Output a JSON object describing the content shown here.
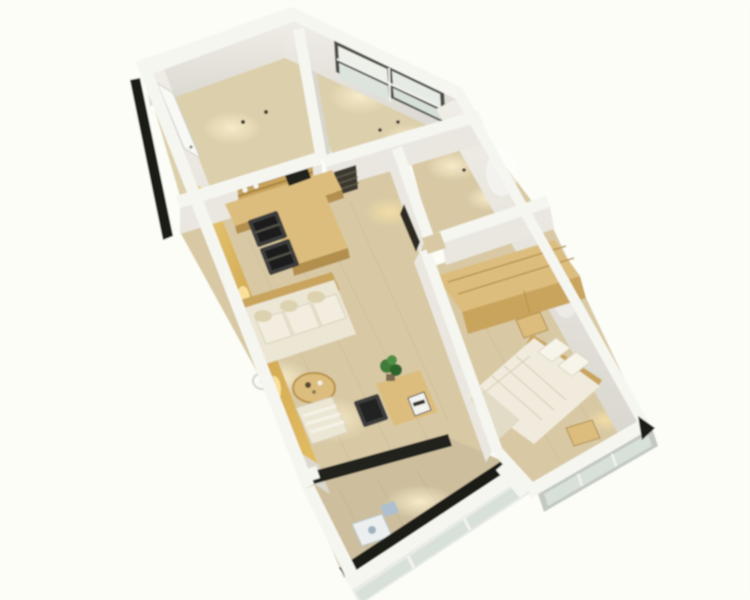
{
  "image": {
    "kind": "3d-apartment-floorplan-render",
    "background": "#fbfcf4"
  },
  "palette": {
    "bg": "#fbfcf4",
    "wall_top": "#f6f6f1",
    "wall_face": "#e9e7e0",
    "wall_face_dark": "#d7d5cd",
    "black_trim": "#1b1a17",
    "floor_a": "#dccfab",
    "floor_b": "#d8c9a4",
    "floor_balcony": "#cdbf9e",
    "wood_gold": "#d8b258",
    "wood_light": "#dcbd7d",
    "wood_mid": "#c9a45c",
    "wood_dark": "#b28f4e",
    "sofa": "#ece6d5",
    "sofa_cushion": "#f2edde",
    "bed": "#f0ebdc",
    "bed_blanket": "#e0d9c3",
    "chair_black": "#1e1e1e",
    "plant_green": "#3f7c38",
    "glass": "#d8e0da",
    "window_frame": "#4d4d46",
    "threshold": "#23221e",
    "light_pool": "#f8ecca"
  },
  "scene": {
    "rooms": [
      {
        "name": "entry-study",
        "features": [
          "entry-door",
          "black-door-trim",
          "ceiling-spotlights"
        ]
      },
      {
        "name": "window-room",
        "features": [
          "four-pane-window"
        ]
      },
      {
        "name": "bathroom",
        "features": [
          "dark-doorway"
        ]
      },
      {
        "name": "master-bedroom",
        "features": [
          "wardrobe",
          "double-bed",
          "pillows",
          "bedside-stool",
          "nightstand",
          "exterior-window",
          "corner-black-wedge"
        ]
      },
      {
        "name": "living-dining",
        "features": [
          "wood-shelf-niche",
          "counter-with-laptop",
          "dining-table",
          "two-black-chairs",
          "gold-wall-cabinets",
          "sofa",
          "floor-lamp",
          "round-coffee-table",
          "armchair",
          "desk",
          "office-chair",
          "potted-plant",
          "slat-shelf"
        ]
      },
      {
        "name": "balcony",
        "features": [
          "glass-parapet",
          "dark-sill",
          "washing-machine",
          "threshold-track"
        ]
      }
    ]
  }
}
